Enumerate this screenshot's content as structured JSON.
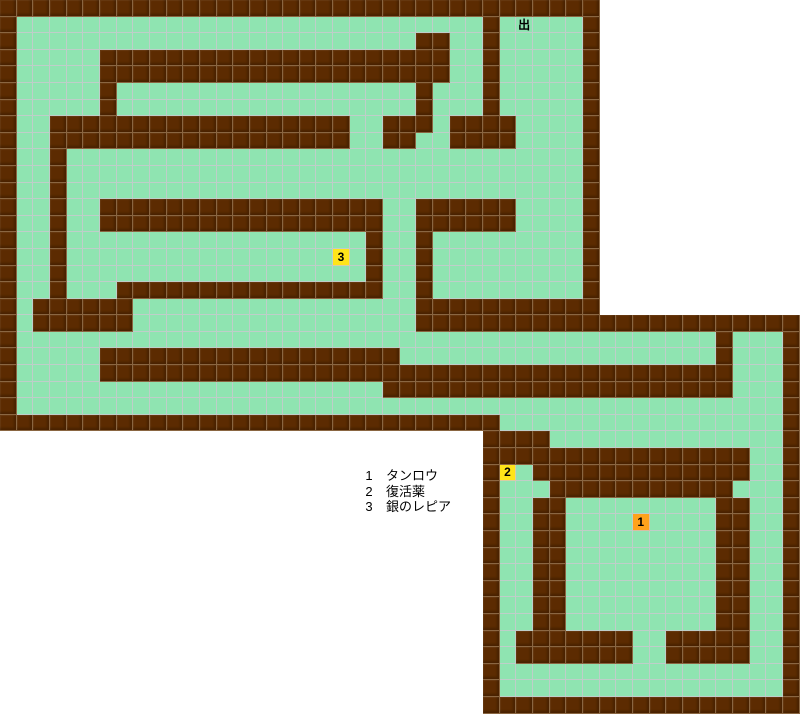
{
  "map": {
    "type": "tile-dungeon-map",
    "grid": {
      "cols": 48,
      "rows": 43,
      "char_key": {
        "#": "wall",
        ".": "floor",
        " ": "empty",
        "E": "exit-floor",
        "A": "marker-1",
        "B": "marker-2",
        "C": "marker-3"
      },
      "cells": [
        "####################################            ",
        "#............................#.E...#            ",
        "#........................##..#.....#            ",
        "#.....#####################..#.....#            ",
        "#.....#####################..#.....#            ",
        "#.....#..................#...#.....#            ",
        "#.....#..................#...#.....#            ",
        "#..##################..###.####....#            ",
        "#..##################..##..####....#            ",
        "#..#...............................#            ",
        "#..#...............................#            ",
        "#..#...............................#            ",
        "#..#..#################..######....#            ",
        "#..#..#################..######....#            ",
        "#..#..................#..#.........#            ",
        "#..#................C.#..#.........#            ",
        "#..#..................#..#.........#            ",
        "#..#...################..#.........#            ",
        "#.######.................###########            ",
        "#.######.................#######################",
        "#..........................................#...#",
        "#.....##################...................#...#",
        "#.....######################################...#",
        "#......................#####################...#",
        "#..............................................#",
        "##############################.................#",
        "                             ####..............#",
        "                             ################..#",
        "                             #B.#############..#",
        "                             #...###########...#",
        "                             #..##.........##..#",
        "                             #..##....A....##..#",
        "                             #..##.........##..#",
        "                             #..##.........##..#",
        "                             #..##.........##..#",
        "                             #..##.........##..#",
        "                             #..##.........##..#",
        "                             #..##.........##..#",
        "                             #.#######..#####..#",
        "                             #.#######..#####..#",
        "                             #.................#",
        "                             #.................#",
        "                             ###################"
      ]
    },
    "exit": {
      "label": "出",
      "row": 1,
      "col": 31
    },
    "markers": [
      {
        "char": "A",
        "digit": "1",
        "row": 31,
        "col": 38,
        "color": "#ffa21c"
      },
      {
        "char": "B",
        "digit": "2",
        "row": 28,
        "col": 30,
        "color": "#ffe419"
      },
      {
        "char": "C",
        "digit": "3",
        "row": 15,
        "col": 20,
        "color": "#ffe419"
      }
    ],
    "colors": {
      "background": "#ffffff",
      "wall": "#5c2b01",
      "floor": "#8fe4b1",
      "floor_gridline": "#cec7d2",
      "wall_gridline": "#a88e6e",
      "marker_yellow": "#ffe419",
      "marker_orange": "#ffa21c",
      "text": "#000000"
    }
  },
  "legend": {
    "items": [
      {
        "num": "1",
        "label": "タンロウ"
      },
      {
        "num": "2",
        "label": "復活薬"
      },
      {
        "num": "3",
        "label": "銀のレピア"
      }
    ]
  }
}
